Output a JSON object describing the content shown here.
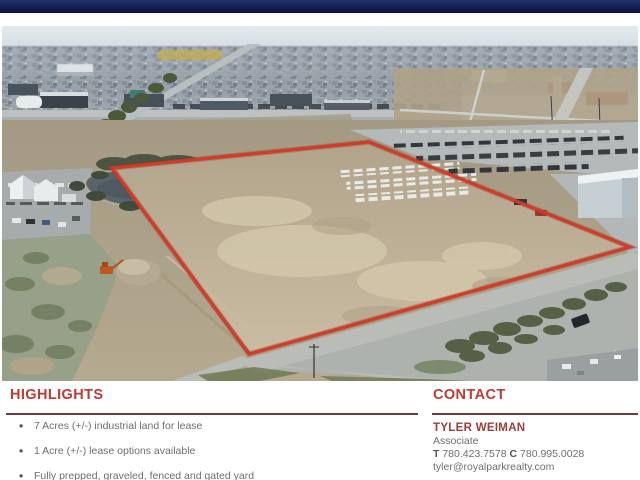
{
  "header": {
    "bar_color": "#13235b"
  },
  "photo": {
    "description": "aerial-view-industrial-land",
    "boundary_color": "#d23b26"
  },
  "highlights": {
    "heading": "HIGHLIGHTS",
    "items": [
      "7 Acres (+/-) industrial land for lease",
      "1 Acre (+/-) lease options available",
      "Fully prepped, graveled, fenced and gated yard"
    ]
  },
  "contact": {
    "heading": "CONTACT",
    "name": "TYLER WEIMAN",
    "title": "Associate",
    "phone_t_label": "T",
    "phone_t": "780.423.7578",
    "phone_c_label": "C",
    "phone_c": "780.995.0028",
    "email": "tyler@royalparkrealty.com"
  },
  "colors": {
    "accent_red": "#bf3a35",
    "rule_maroon": "#6d3b40",
    "name_red": "#a23c36",
    "body_gray": "#6e6e6e"
  }
}
